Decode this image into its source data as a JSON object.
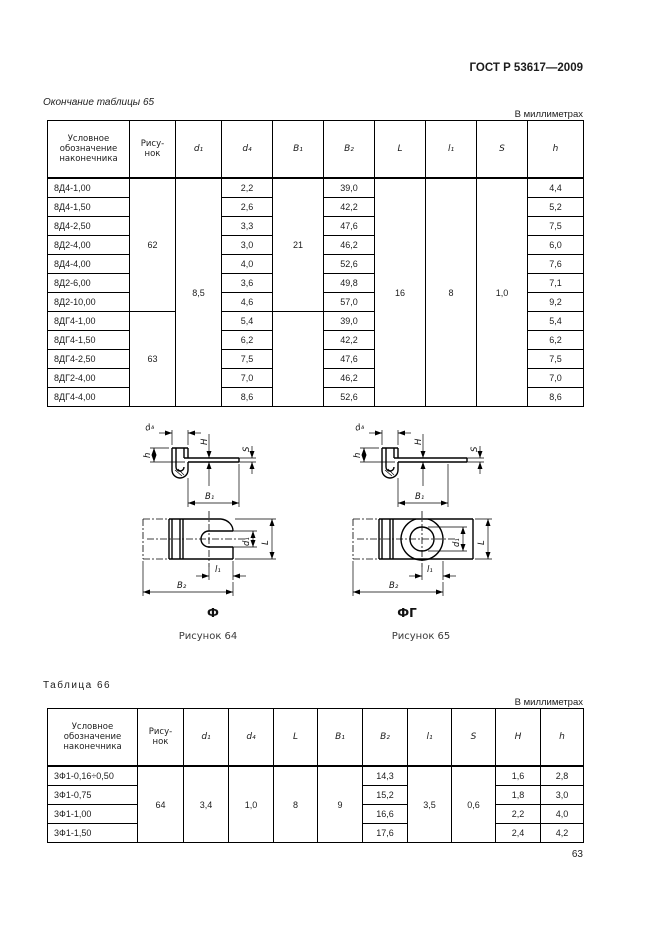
{
  "page": {
    "standard_ref": "ГОСТ Р 53617—2009",
    "page_number": "63"
  },
  "table65": {
    "caption": "Окончание таблицы 65",
    "units": "В миллиметрах",
    "headers": {
      "designation": "Условное обозначение наконечника",
      "figure": "Рису-нок",
      "d1": "d₁",
      "d4": "d₄",
      "B1": "B₁",
      "B2": "B₂",
      "L": "L",
      "l1": "l₁",
      "S": "S",
      "h": "h"
    },
    "merged": {
      "figure_top": "62",
      "figure_bottom": "63",
      "d1": "8,5",
      "B1_top": "21",
      "B1_bottom": "",
      "L": "16",
      "l1": "8",
      "S": "1,0"
    },
    "rows": [
      {
        "name": "8Д4-1,00",
        "d4": "2,2",
        "B2": "39,0",
        "h": "4,4"
      },
      {
        "name": "8Д4-1,50",
        "d4": "2,6",
        "B2": "42,2",
        "h": "5,2"
      },
      {
        "name": "8Д4-2,50",
        "d4": "3,3",
        "B2": "47,6",
        "h": "7,5"
      },
      {
        "name": "8Д2-4,00",
        "d4": "3,0",
        "B2": "46,2",
        "h": "6,0"
      },
      {
        "name": "8Д4-4,00",
        "d4": "4,0",
        "B2": "52,6",
        "h": "7,6"
      },
      {
        "name": "8Д2-6,00",
        "d4": "3,6",
        "B2": "49,8",
        "h": "7,1"
      },
      {
        "name": "8Д2-10,00",
        "d4": "4,6",
        "B2": "57,0",
        "h": "9,2"
      },
      {
        "name": "8ДГ4-1,00",
        "d4": "5,4",
        "B2": "39,0",
        "h": "5,4"
      },
      {
        "name": "8ДГ4-1,50",
        "d4": "6,2",
        "B2": "42,2",
        "h": "6,2"
      },
      {
        "name": "8ДГ4-2,50",
        "d4": "7,5",
        "B2": "47,6",
        "h": "7,5"
      },
      {
        "name": "8ДГ2-4,00",
        "d4": "7,0",
        "B2": "46,2",
        "h": "7,0"
      },
      {
        "name": "8ДГ4-4,00",
        "d4": "8,6",
        "B2": "52,6",
        "h": "8,6"
      }
    ]
  },
  "figures": {
    "dims": {
      "d4": "d₄",
      "h": "h",
      "H": "H",
      "S": "S",
      "B1": "B₁",
      "d1": "d₁",
      "L": "L",
      "l1": "l₁",
      "B2": "B₂"
    },
    "fig64": {
      "type_label": "Ф",
      "caption": "Рисунок 64"
    },
    "fig65": {
      "type_label": "ФГ",
      "caption": "Рисунок 65"
    }
  },
  "table66": {
    "caption": "Таблица 66",
    "units": "В миллиметрах",
    "headers": {
      "designation": "Условное обозначение наконечника",
      "figure": "Рису-нок",
      "d1": "d₁",
      "d4": "d₄",
      "L": "L",
      "B1": "B₁",
      "B2": "B₂",
      "l1": "l₁",
      "S": "S",
      "H": "H",
      "h": "h"
    },
    "merged": {
      "figure": "64",
      "d1": "3,4",
      "d4": "1,0",
      "L": "8",
      "B1": "9",
      "l1": "3,5",
      "S": "0,6"
    },
    "rows": [
      {
        "name": "3Ф1-0,16÷0,50",
        "B2": "14,3",
        "H": "1,6",
        "h": "2,8"
      },
      {
        "name": "3Ф1-0,75",
        "B2": "15,2",
        "H": "1,8",
        "h": "3,0"
      },
      {
        "name": "3Ф1-1,00",
        "B2": "16,6",
        "H": "2,2",
        "h": "4,0"
      },
      {
        "name": "3Ф1-1,50",
        "B2": "17,6",
        "H": "2,4",
        "h": "4,2"
      }
    ]
  }
}
